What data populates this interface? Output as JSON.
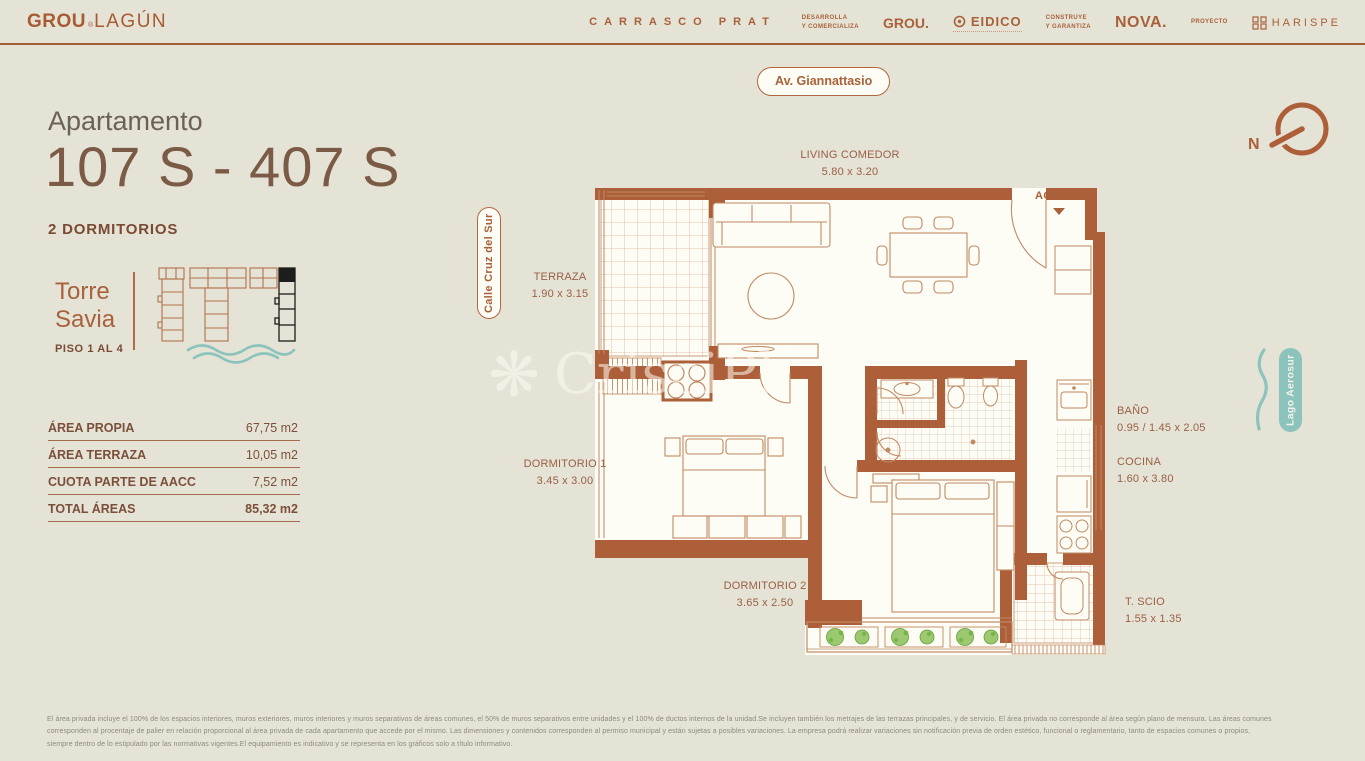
{
  "header": {
    "logo_grou": "GROU",
    "logo_reg": "®",
    "logo_lagun": "LAGÚN",
    "project_name": "CARRASCO PRAT",
    "dev_role": "DESARROLLA\nY COMERCIALIZA",
    "dev_name1": "GROU.",
    "dev_name2": "EIDICO",
    "build_role": "CONSTRUYE\nY GARANTIZA",
    "build_name": "NOVA.",
    "proj_role": "PROYECTO",
    "proj_name": "HARISPE"
  },
  "apartment": {
    "label": "Apartamento",
    "number": "107 S - 407 S",
    "bedrooms": "2 DORMITORIOS",
    "tower": "Torre\nSavia",
    "floors": "PISO 1 AL 4"
  },
  "areas": {
    "rows": [
      {
        "label": "ÁREA PROPIA",
        "value": "67,75 m2"
      },
      {
        "label": "ÁREA TERRAZA",
        "value": "10,05 m2"
      },
      {
        "label": "CUOTA PARTE DE AACC",
        "value": "7,52 m2"
      },
      {
        "label": "TOTAL ÁREAS",
        "value": "85,32 m2"
      }
    ]
  },
  "map_labels": {
    "street_top": "Av. Giannattasio",
    "street_left": "Calle Cruz del Sur",
    "lake_right": "Lago Aerosur",
    "compass_n": "N"
  },
  "plan": {
    "access_label": "ACCESO",
    "watermark": "CrisciPl",
    "rooms": [
      {
        "name": "LIVING COMEDOR",
        "dims": "5.80 x 3.20"
      },
      {
        "name": "TERRAZA",
        "dims": "1.90 x 3.15"
      },
      {
        "name": "DORMITORIO 1",
        "dims": "3.45 x 3.00"
      },
      {
        "name": "DORMITORIO 2",
        "dims": "3.65 x 2.50"
      },
      {
        "name": "BAÑO",
        "dims": "0.95 / 1.45 x 2.05"
      },
      {
        "name": "COCINA",
        "dims": "1.60 x 3.80"
      },
      {
        "name": "T. SCIO",
        "dims": "1.55 x 1.35"
      }
    ]
  },
  "disclaimer": {
    "text": "El área privada incluye el 100% de los espacios interiores, muros exteriores, muros interiores y muros separativos de áreas comunes, el 50% de muros separativos entre unidades y el 100% de ductos internos de la unidad.Se incluyen también los metrajes de las terrazas principales, y de servicio. El área privada no corresponde al área según plano de mensura. Las áreas comunes\ncorresponden al procentaje de palier en relación proporcional al área privada de cada apartamento que accede por el mismo. Las dimensiones y contenidos corresponden al permiso municipal y están sujetas a posibles variaciones. La empresa podrá realizar variaciones sin notificación previa de orden estético, funcional o reglamentario, tanto de espacios comunes o propios,\nsiempre dentro de lo estipulado por las normativas vigentes.El equipamiento es indicativo y se representa en los gráficos solo a título informativo."
  },
  "colors": {
    "background": "#e4e3d5",
    "accent_rust": "#ad5f39",
    "text_brown": "#9a6047",
    "teal": "#8cc3bd",
    "dark_tower": "#1d1d1b",
    "plan_paper": "#fdfcf5",
    "plant_green": "#76b54a"
  }
}
